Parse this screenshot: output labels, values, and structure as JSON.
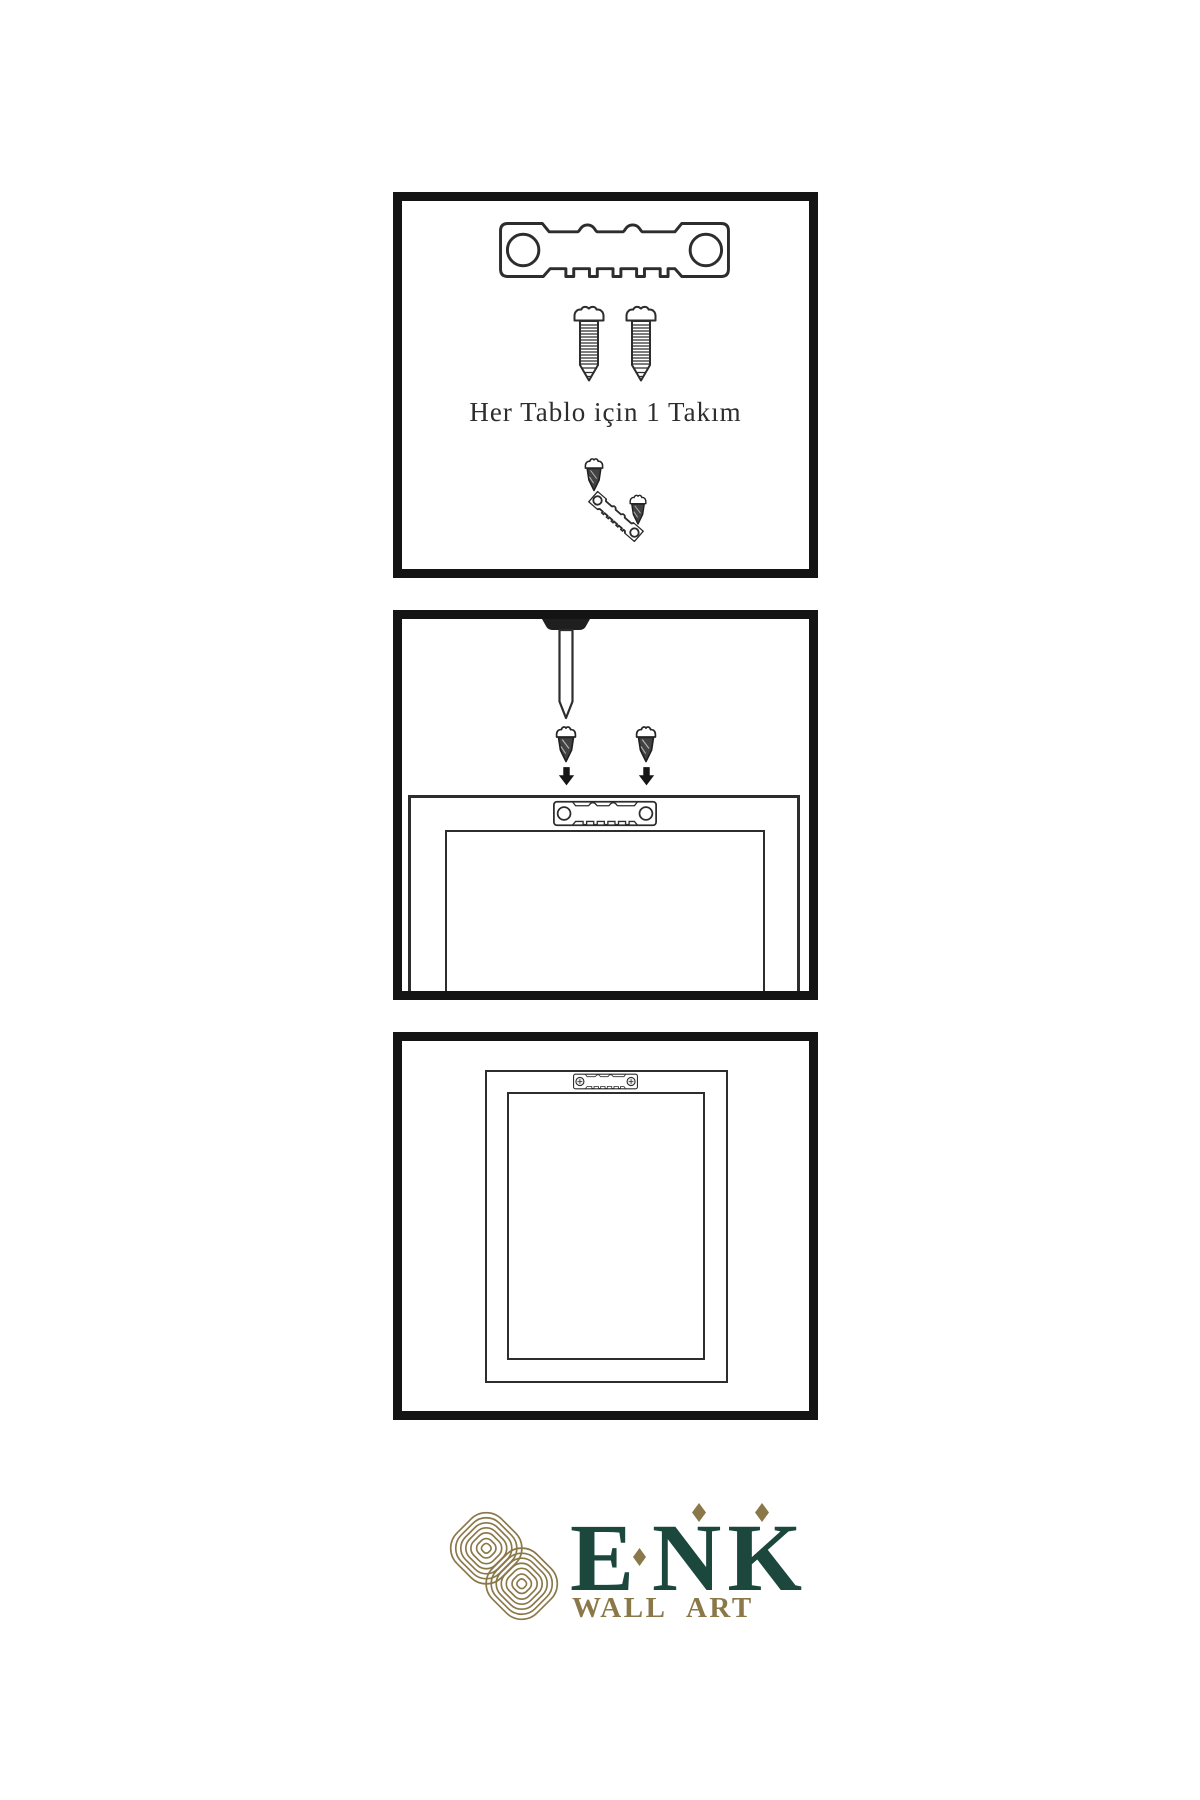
{
  "page": {
    "width": 1200,
    "height": 1800,
    "background": "#ffffff"
  },
  "steps": [
    {
      "name": "hardware-kit",
      "caption": "Her Tablo için 1 Takım",
      "parts": [
        "sawtooth-hanger",
        "screw",
        "screw",
        "dark-screw",
        "angled-sawtooth-hanger",
        "dark-screw"
      ]
    },
    {
      "name": "attach-hanger-to-frame",
      "parts": [
        "wall-nail",
        "dark-screw",
        "down-arrow",
        "dark-screw",
        "down-arrow",
        "frame-back",
        "sawtooth-hanger-plate"
      ]
    },
    {
      "name": "hanger-mounted-on-frame",
      "parts": [
        "frame-back",
        "sawtooth-hanger-with-screws"
      ]
    }
  ],
  "brand": {
    "wordmark": "ENK",
    "letters": [
      "E",
      "N",
      "K"
    ],
    "tagline": "WALL ART"
  },
  "icons": {
    "sawtooth-hanger-icon": "svg#sym-hanger-cut",
    "screw-icon": "svg#sym-screw-threaded",
    "dark-screw-icon": "svg#sym-screw-dark",
    "down-arrow-icon": "svg#sym-arrow-down",
    "nail-icon": "svg#sym-nail",
    "sawtooth-hanger-plate-icon": "svg#sym-plate",
    "sawtooth-hanger-mounted-icon": "svg#sym-plate-screwed",
    "knot-logo-icon": "svg#sym-knot",
    "diamond-icon": "css-clip-path-diamond"
  },
  "colors": {
    "background": "#ffffff",
    "panel-border": "#141414",
    "line-art": "#2d2d2d",
    "brand-green": "#1c473c",
    "brand-gold": "#8a7849"
  }
}
